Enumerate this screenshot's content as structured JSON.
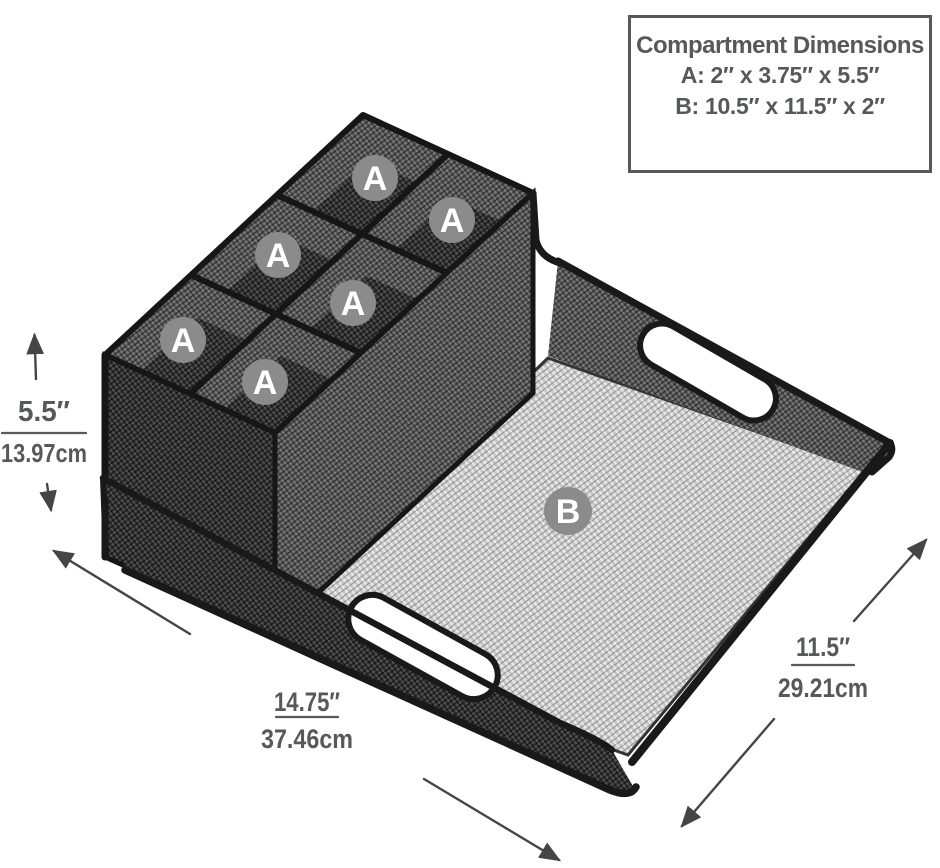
{
  "info_box": {
    "title": "Compartment Dimensions",
    "line_a": "A: 2″ x 3.75″ x 5.5″",
    "line_b": "B: 10.5″ x 11.5″ x 2″"
  },
  "badges": {
    "a": "A",
    "b": "B"
  },
  "dimensions": {
    "height_in": "5.5″",
    "height_cm": "13.97cm",
    "width_in": "14.75″",
    "width_cm": "37.46cm",
    "depth_in": "11.5″",
    "depth_cm": "29.21cm"
  },
  "colors": {
    "annotation_text": "#57585a",
    "badge_gray": "#8b8b8b",
    "frame_black": "#191919",
    "arrow_gray": "#454545"
  }
}
